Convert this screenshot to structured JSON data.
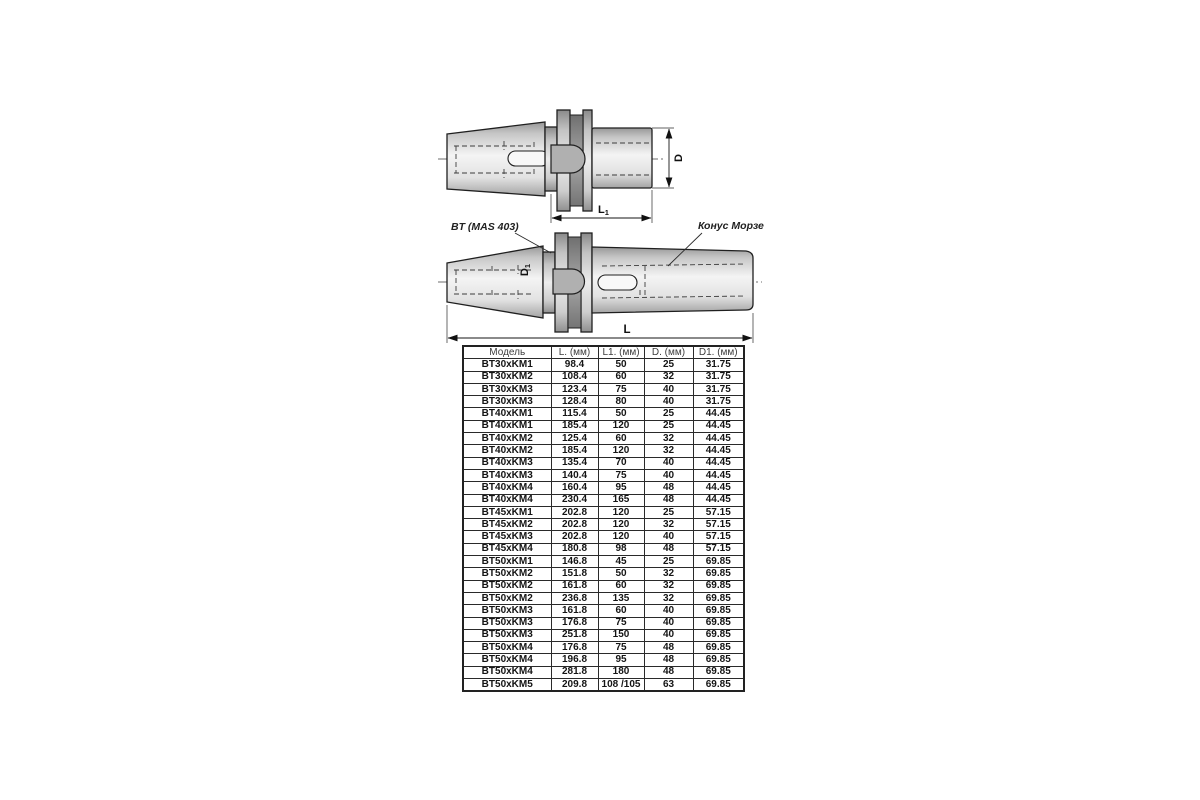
{
  "drawing_top": {
    "dim_d": "D",
    "dim_l1_main": "L",
    "dim_l1_sub": "1"
  },
  "drawing_bottom": {
    "label_bt": "BT (MAS 403)",
    "label_morse": "Конус Морзе",
    "dim_d1_main": "D",
    "dim_d1_sub": "1",
    "dim_l": "L"
  },
  "colors": {
    "background": "#ffffff",
    "line": "#1f1f1f",
    "metal_light": "#f4f4f4",
    "metal_dark": "#9a9a9a",
    "groove": "#8a8a8a"
  },
  "table": {
    "headers": [
      "Модель",
      "L. (мм)",
      "L1. (мм)",
      "D. (мм)",
      "D1. (мм)"
    ],
    "rows": [
      [
        "BT30xKM1",
        "98.4",
        "50",
        "25",
        "31.75"
      ],
      [
        "BT30xKM2",
        "108.4",
        "60",
        "32",
        "31.75"
      ],
      [
        "BT30xKM3",
        "123.4",
        "75",
        "40",
        "31.75"
      ],
      [
        "BT30xKM3",
        "128.4",
        "80",
        "40",
        "31.75"
      ],
      [
        "BT40xKM1",
        "115.4",
        "50",
        "25",
        "44.45"
      ],
      [
        "BT40xKM1",
        "185.4",
        "120",
        "25",
        "44.45"
      ],
      [
        "BT40xKM2",
        "125.4",
        "60",
        "32",
        "44.45"
      ],
      [
        "BT40xKM2",
        "185.4",
        "120",
        "32",
        "44.45"
      ],
      [
        "BT40xKM3",
        "135.4",
        "70",
        "40",
        "44.45"
      ],
      [
        "BT40xKM3",
        "140.4",
        "75",
        "40",
        "44.45"
      ],
      [
        "BT40xKM4",
        "160.4",
        "95",
        "48",
        "44.45"
      ],
      [
        "BT40xKM4",
        "230.4",
        "165",
        "48",
        "44.45"
      ],
      [
        "BT45xKM1",
        "202.8",
        "120",
        "25",
        "57.15"
      ],
      [
        "BT45xKM2",
        "202.8",
        "120",
        "32",
        "57.15"
      ],
      [
        "BT45xKM3",
        "202.8",
        "120",
        "40",
        "57.15"
      ],
      [
        "BT45xKM4",
        "180.8",
        "98",
        "48",
        "57.15"
      ],
      [
        "BT50xKM1",
        "146.8",
        "45",
        "25",
        "69.85"
      ],
      [
        "BT50xKM2",
        "151.8",
        "50",
        "32",
        "69.85"
      ],
      [
        "BT50xKM2",
        "161.8",
        "60",
        "32",
        "69.85"
      ],
      [
        "BT50xKM2",
        "236.8",
        "135",
        "32",
        "69.85"
      ],
      [
        "BT50xKM3",
        "161.8",
        "60",
        "40",
        "69.85"
      ],
      [
        "BT50xKM3",
        "176.8",
        "75",
        "40",
        "69.85"
      ],
      [
        "BT50xKM3",
        "251.8",
        "150",
        "40",
        "69.85"
      ],
      [
        "BT50xKM4",
        "176.8",
        "75",
        "48",
        "69.85"
      ],
      [
        "BT50xKM4",
        "196.8",
        "95",
        "48",
        "69.85"
      ],
      [
        "BT50xKM4",
        "281.8",
        "180",
        "48",
        "69.85"
      ],
      [
        "BT50xKM5",
        "209.8",
        "108 /105",
        "63",
        "69.85"
      ]
    ]
  }
}
